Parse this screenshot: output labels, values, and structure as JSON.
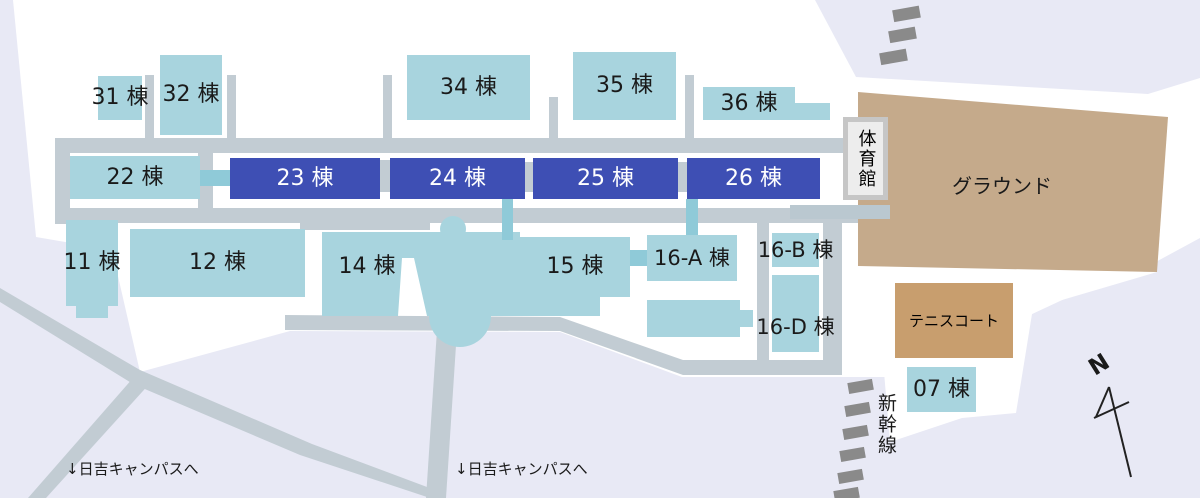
{
  "buildings": [
    {
      "id": "31",
      "label": "31 棟"
    },
    {
      "id": "32",
      "label": "32 棟"
    },
    {
      "id": "34",
      "label": "34 棟"
    },
    {
      "id": "35",
      "label": "35 棟"
    },
    {
      "id": "36",
      "label": "36 棟"
    },
    {
      "id": "22",
      "label": "22 棟"
    },
    {
      "id": "23",
      "label": "23 棟"
    },
    {
      "id": "24",
      "label": "24 棟"
    },
    {
      "id": "25",
      "label": "25 棟"
    },
    {
      "id": "26",
      "label": "26 棟"
    },
    {
      "id": "11",
      "label": "11 棟"
    },
    {
      "id": "12",
      "label": "12 棟"
    },
    {
      "id": "14",
      "label": "14 棟"
    },
    {
      "id": "15",
      "label": "15 棟"
    },
    {
      "id": "16A",
      "label": "16-A 棟"
    },
    {
      "id": "16B",
      "label": "16-B 棟"
    },
    {
      "id": "16D",
      "label": "16-D 棟"
    },
    {
      "id": "07",
      "label": "07 棟"
    }
  ],
  "areas": {
    "ground": "グラウンド",
    "tennis_court": "テニスコート",
    "gym": "体育館"
  },
  "annotations": {
    "north": "N",
    "shinkansen": "新幹線",
    "hiyoshi_1": "↓日吉キャンパスへ",
    "hiyoshi_2": "↓日吉キャンパスへ"
  },
  "colors": {
    "building_light": "#a8d4de",
    "building_dark": "#3e4fb4",
    "connector_teal": "#8fcad8",
    "road_gray": "#c2ccd3",
    "ground_brown": "#c5aa8b",
    "tennis_brown": "#c89e6e",
    "background_lavender": "#e8e9f5",
    "railway_dash_gray": "#8a8a8a",
    "gym_border_gray": "#c6c6c6"
  }
}
